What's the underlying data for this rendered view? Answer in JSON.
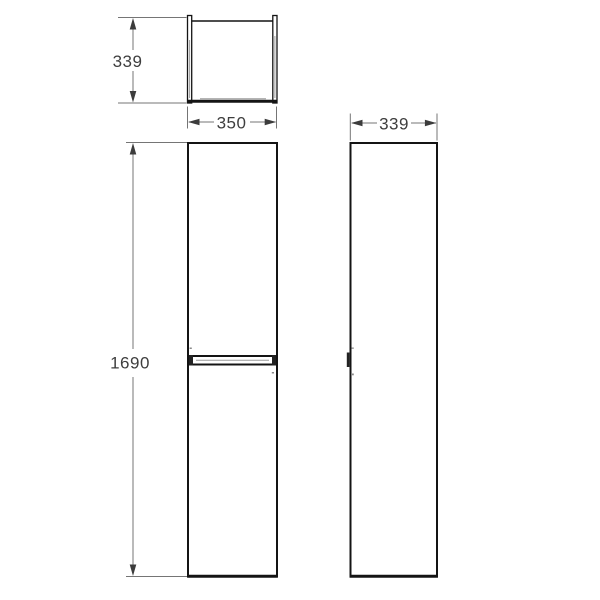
{
  "drawing": {
    "kind": "cabinet-three-view-technical-drawing",
    "dimension_labels": {
      "top_depth": "339",
      "front_width": "350",
      "front_height": "1690",
      "side_depth": "339"
    },
    "colors": {
      "background": "#ffffff",
      "object_line": "#141414",
      "dimension_line": "#757575",
      "arrowhead": "#3c3c3c",
      "label_text": "#3e3e3e",
      "shading": "#9c9c9c"
    }
  }
}
